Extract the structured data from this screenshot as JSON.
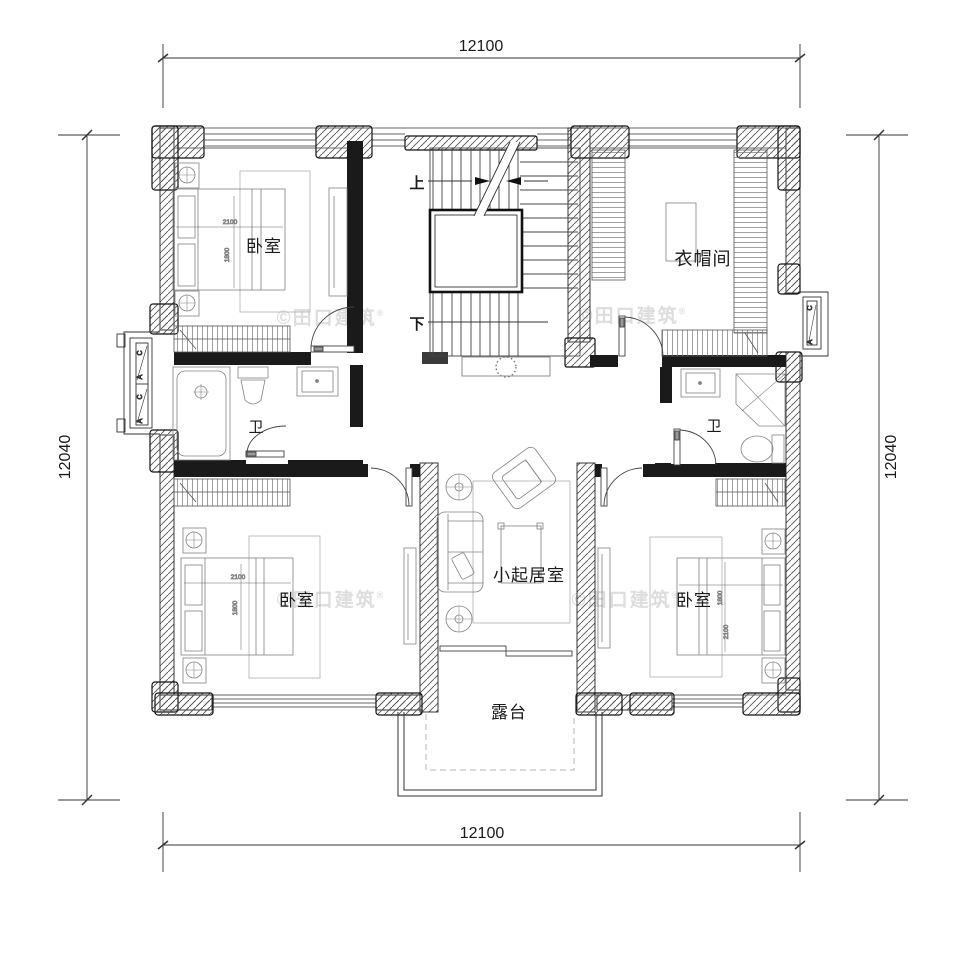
{
  "drawing": {
    "type": "residential floor plan (second floor)",
    "dims": {
      "width": "12100",
      "height": "12040"
    },
    "rooms": {
      "bedroom": "卧室",
      "cloakroom": "衣帽间",
      "bath": "卫",
      "living": "小起居室",
      "terrace": "露台"
    },
    "stairs": {
      "up": "上",
      "down": "下"
    },
    "bed": {
      "length": "2100",
      "width": "1800"
    },
    "windows": {
      "a": "A",
      "c": "C"
    },
    "watermark": {
      "text": "©田口建筑",
      "reg": "®"
    },
    "colors": {
      "wall": "#1a1a1a",
      "hatch": "#555555",
      "furniture": "#828282",
      "watermark": "#dcdcdc"
    }
  }
}
